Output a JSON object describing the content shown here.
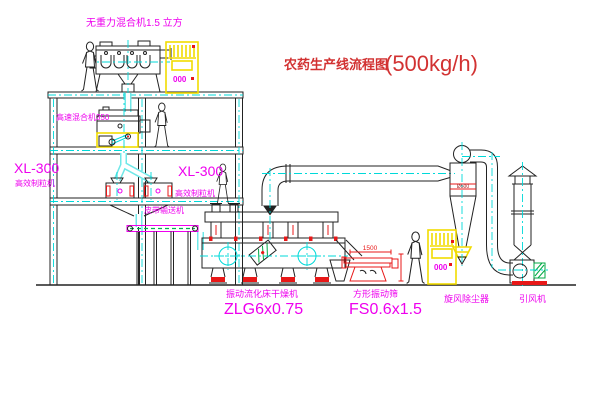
{
  "drawing": {
    "title_zh": "农药生产线流程图",
    "title_capacity": "(500kg/h)"
  },
  "labels": {
    "gravity_mixer": "无重力混合机1.5 立方",
    "high_speed_mixer": "高速混合机350",
    "granulator_left_model": "XL-300",
    "granulator_left_name": "高效制粒机",
    "granulator_right_model": "XL-300",
    "granulator_right_name": "高效制粒机",
    "belt_conveyor": "皮带输送机",
    "fbd_name": "振动流化床干燥机",
    "fbd_model": "ZLG6x0.75",
    "sieve_name": "方形振动筛",
    "sieve_model": "FS0.6x1.5",
    "cyclone_name": "旋风除尘器",
    "fan_name": "引风机"
  },
  "dimensions": {
    "sieve_length": "1500",
    "cyclone_note": "Ø500"
  },
  "cabinets": {
    "top_label": "000",
    "right_label": "000"
  },
  "colors": {
    "line": "#222222",
    "magenta": "#ee00ee",
    "cyan": "#00d9d9",
    "red": "#e81818",
    "yellow": "#f2dc00",
    "green": "#00a844",
    "title_red": "#d23232"
  }
}
